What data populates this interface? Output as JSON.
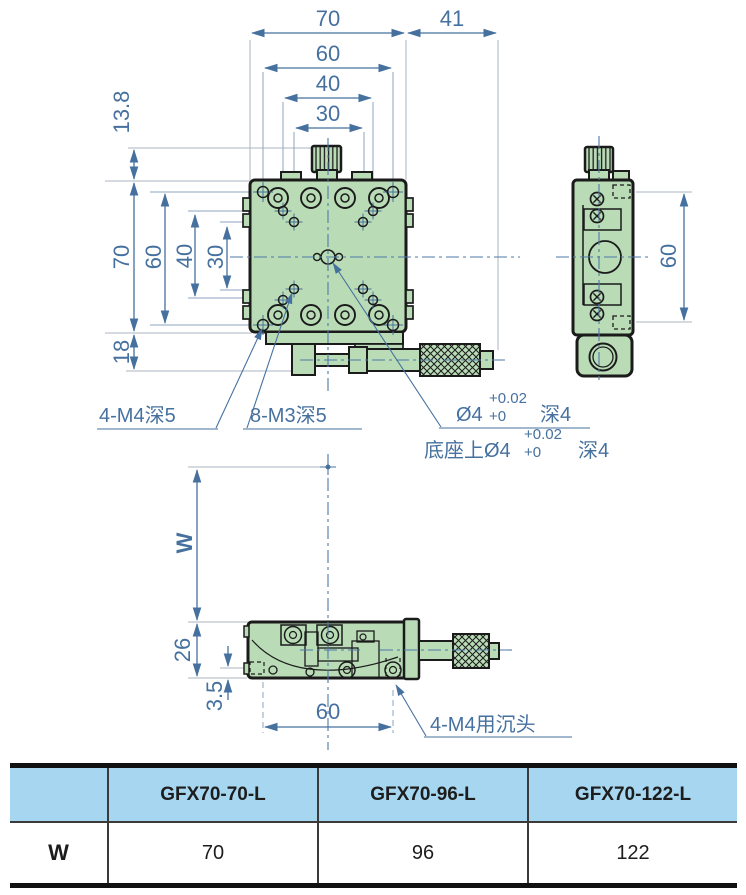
{
  "colors": {
    "body_green": "#b9dcb6",
    "outline": "#1b1b1b",
    "dimension_blue": "#46719f",
    "table_header_blue": "#a7d7f0"
  },
  "views": {
    "top": {
      "dim_width": "70",
      "dim_micrometer": "41",
      "dim_h60": "60",
      "dim_h40": "40",
      "dim_h30": "30",
      "dim_knob": "13.8",
      "dim_v70": "70",
      "dim_v60": "60",
      "dim_v40": "40",
      "dim_v30": "30",
      "dim_v18": "18"
    },
    "side": {
      "dim_60": "60"
    },
    "bottom": {
      "dim_w": "W",
      "dim_26": "26",
      "dim_35": "3.5",
      "dim_60": "60"
    }
  },
  "callouts": {
    "corner_holes": "4-M4深5",
    "grid_holes": "8-M3深5",
    "pin": {
      "dia": "Ø4",
      "tol_upper": "+0.02",
      "tol_lower": "+0",
      "depth": "深4"
    },
    "base_pin": {
      "prefix": "底座上Ø4",
      "tol_upper": "+0.02",
      "tol_lower": "+0",
      "depth": "深4"
    },
    "countersink": "4-M4用沉头"
  },
  "table": {
    "corner_label": "",
    "models": [
      "GFX70-70-L",
      "GFX70-96-L",
      "GFX70-122-L"
    ],
    "row_label": "W",
    "values": [
      "70",
      "96",
      "122"
    ]
  }
}
